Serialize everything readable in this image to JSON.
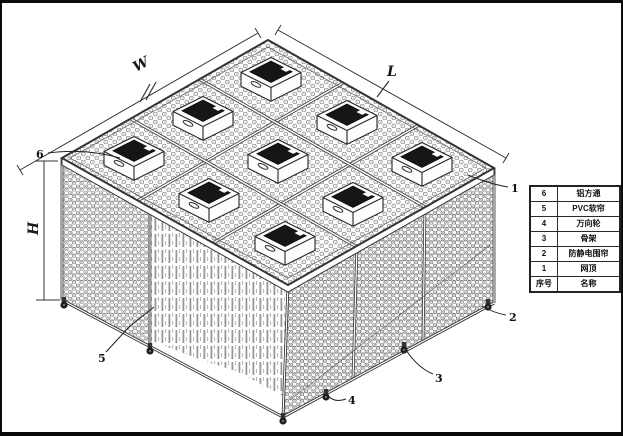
{
  "dimension_labels": {
    "width": "W",
    "length": "L",
    "height": "H"
  },
  "callouts": {
    "c1": "1",
    "c2": "2",
    "c3": "3",
    "c4": "4",
    "c5": "5",
    "c6": "6"
  },
  "parts_table": {
    "header": {
      "no": "序号",
      "name": "名称"
    },
    "rows": [
      {
        "no": "6",
        "name": "铝方通"
      },
      {
        "no": "5",
        "name": "PVC软帘"
      },
      {
        "no": "4",
        "name": "万向轮"
      },
      {
        "no": "3",
        "name": "骨架"
      },
      {
        "no": "2",
        "name": "防静电围帘"
      },
      {
        "no": "1",
        "name": "网顶"
      }
    ]
  },
  "colors": {
    "line": "#333333",
    "background": "#ffffff",
    "ffu_panel": "#161616"
  }
}
